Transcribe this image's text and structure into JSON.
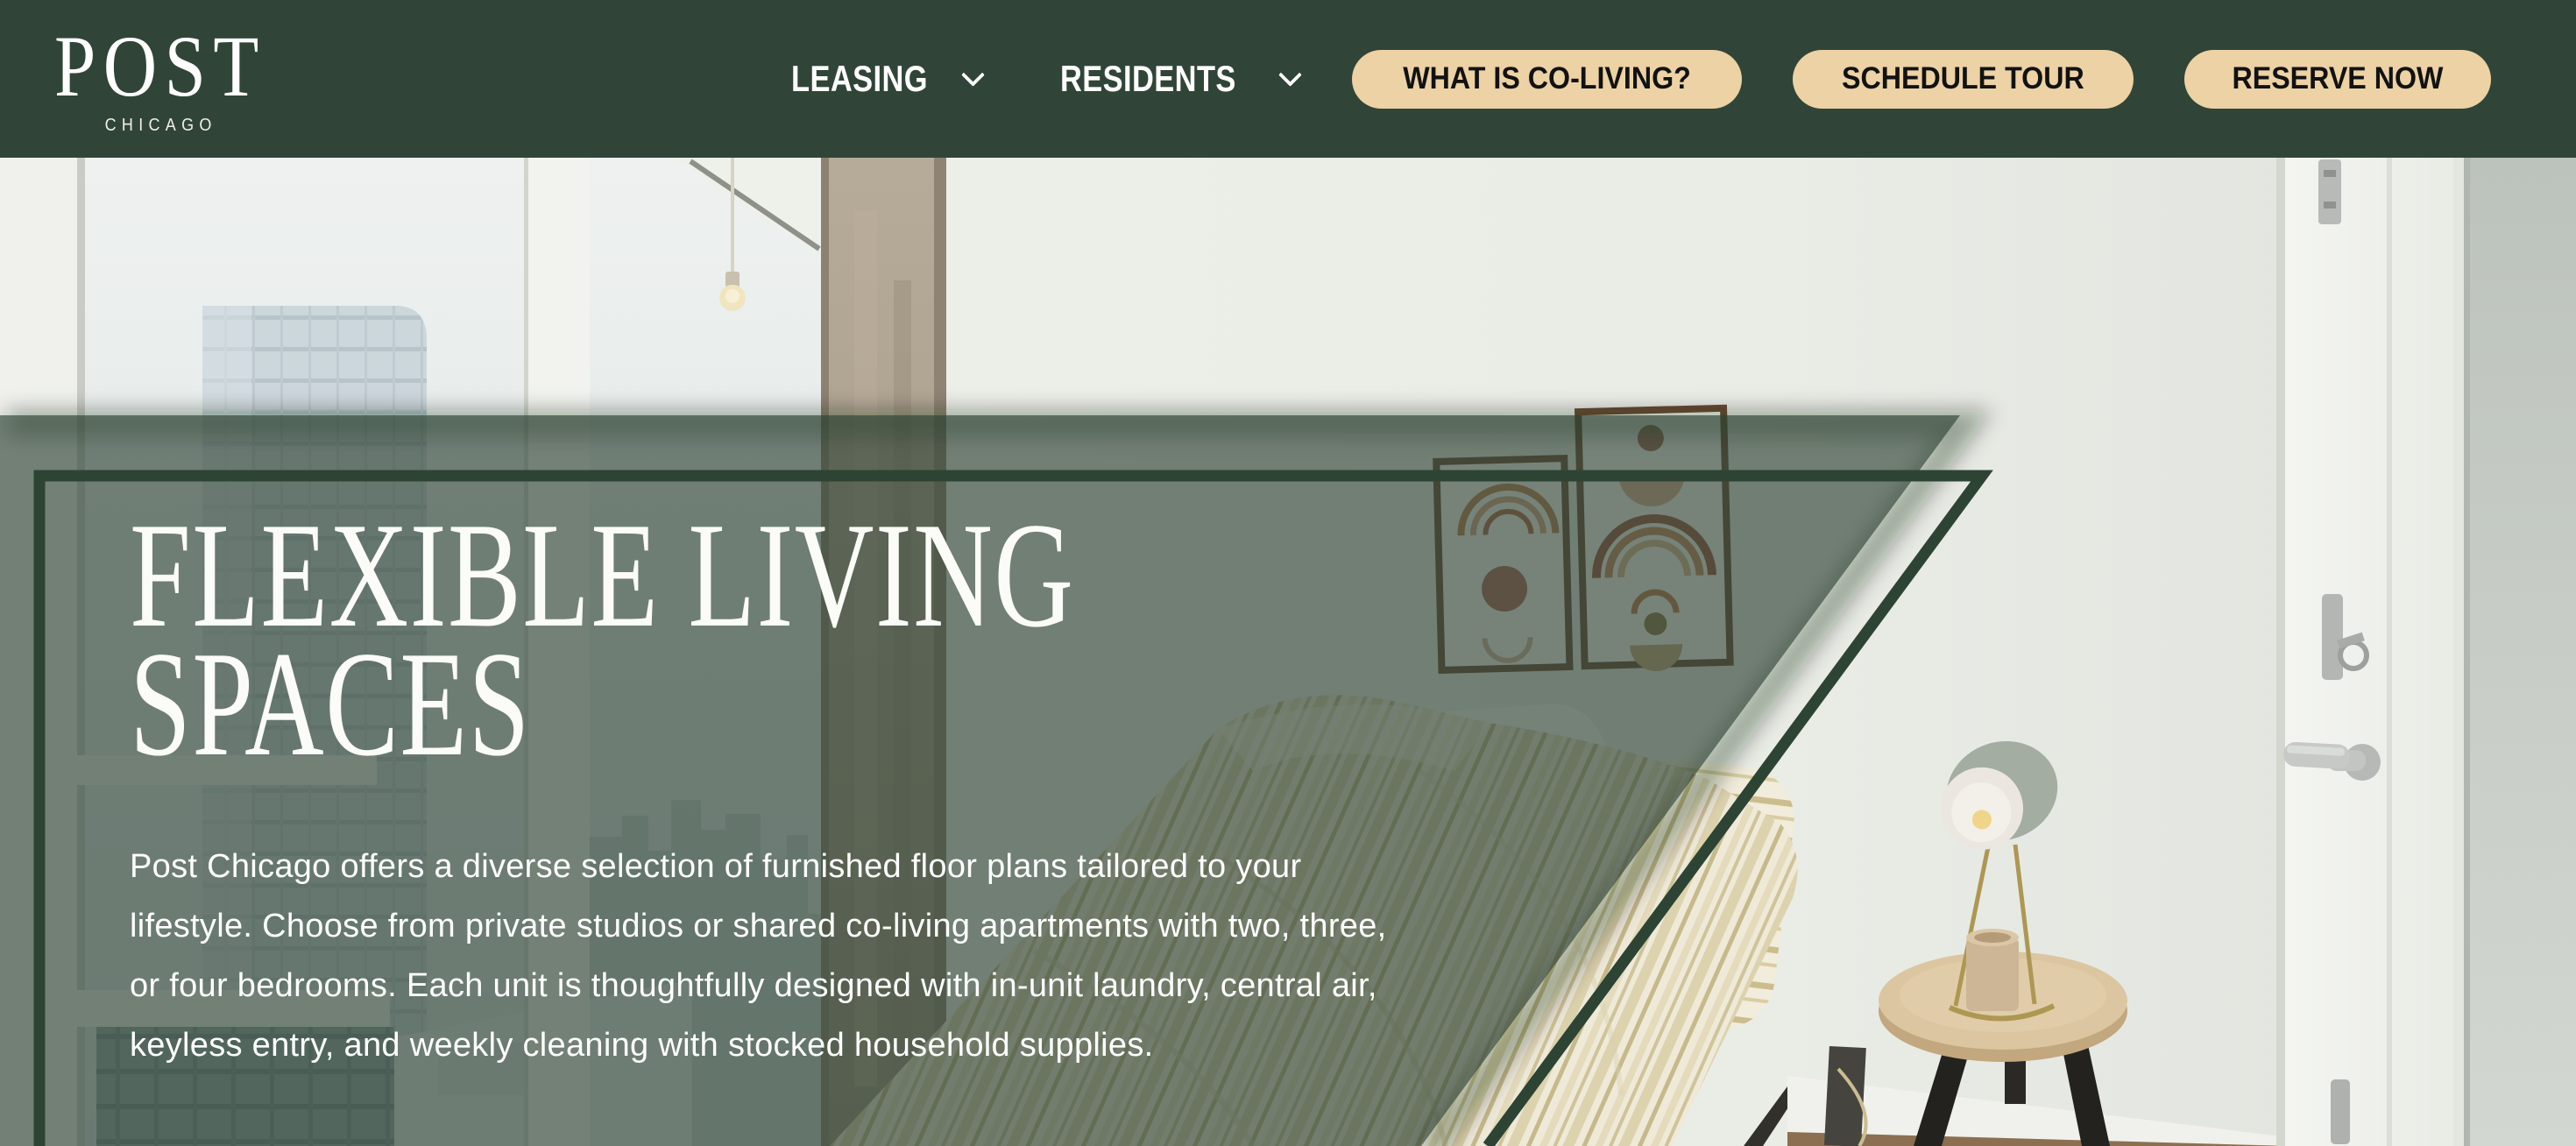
{
  "brand": {
    "name": "POST",
    "city": "CHICAGO"
  },
  "nav": {
    "links": [
      {
        "label": "LEASING",
        "has_dropdown": true
      },
      {
        "label": "RESIDENTS",
        "has_dropdown": true
      }
    ],
    "buttons": [
      {
        "label": "WHAT IS CO-LIVING?"
      },
      {
        "label": "SCHEDULE TOUR"
      },
      {
        "label": "RESERVE NOW"
      }
    ]
  },
  "hero": {
    "heading_lines": [
      "FLEXIBLE LIVING",
      "SPACES"
    ],
    "paragraph_lines": [
      "Post Chicago offers a diverse selection of furnished floor plans tailored to your",
      "lifestyle. Choose from private studios or shared co-living apartments with two, three,",
      "or four bedrooms. Each unit is thoughtfully designed with in-unit laundry, central air,",
      "keyless entry, and weekly cleaning with stocked household supplies."
    ],
    "photo_description": "Furnished bedroom with floor-to-ceiling city-view window, concrete pillar, two framed boho art prints, bed with striped duvet and mustard pillow, wood nightstand with sage lamp and candle, and a white door with nickel hardware"
  },
  "colors": {
    "nav_green": "#304538",
    "frame_green": "#2d4434",
    "overlay_green": "rgba(48,68,54,0.65)",
    "accent_tan": "#ecd2a4",
    "button_text": "#121212",
    "text_white": "#ffffff"
  }
}
